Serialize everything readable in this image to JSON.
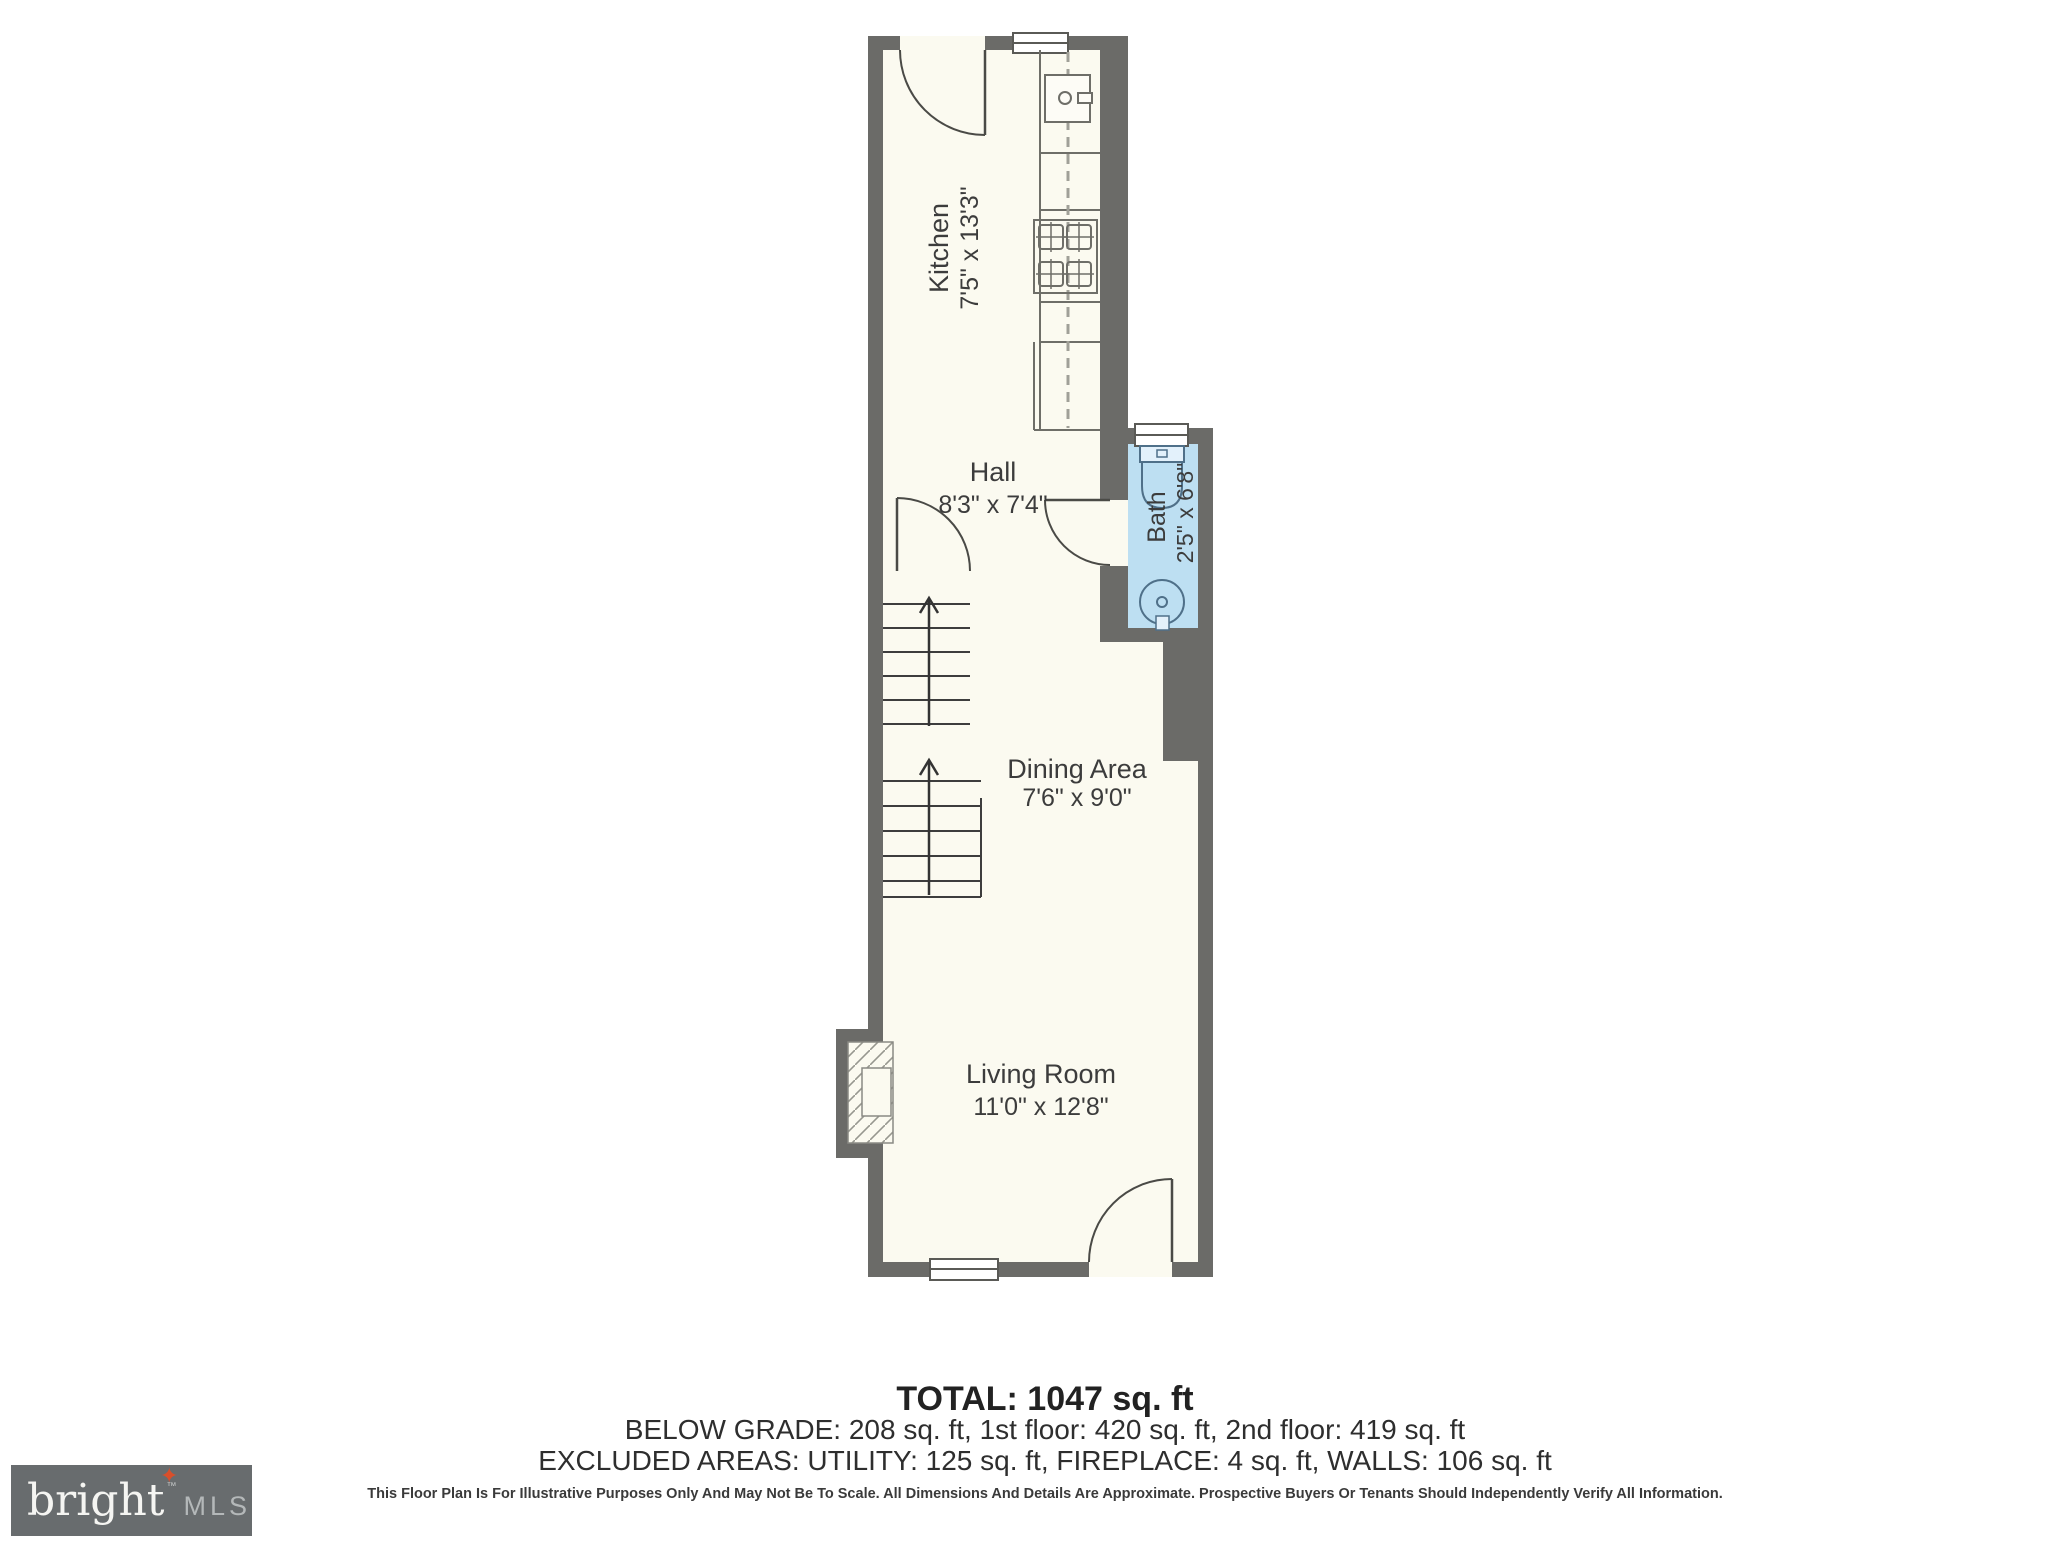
{
  "plan": {
    "rooms": [
      {
        "name": "Kitchen",
        "dims": "7'5\" x 13'3\""
      },
      {
        "name": "Hall",
        "dims": "8'3\" x 7'4\""
      },
      {
        "name": "Bath",
        "dims": "2'5\" x 6'8\""
      },
      {
        "name": "Dining Area",
        "dims": "7'6\" x 9'0\""
      },
      {
        "name": "Living Room",
        "dims": "11'0\" x 12'8\""
      }
    ],
    "colors": {
      "wall": "#6b6b68",
      "floor": "#fbfaf0",
      "bath_fill": "#bddff2",
      "label_text": "#3c3c3c",
      "logo_box": "#686c6e",
      "logo_brand": "#f5f5f2",
      "logo_star": "#d94f2b",
      "logo_mls": "#b4b8b9"
    }
  },
  "summary": {
    "total": "TOTAL: 1047 sq. ft",
    "below_grade": "BELOW GRADE: 208 sq. ft, 1st floor: 420 sq. ft, 2nd floor: 419 sq. ft",
    "excluded": "EXCLUDED AREAS: UTILITY: 125 sq. ft, FIREPLACE: 4 sq. ft, WALLS: 106 sq. ft",
    "disclaimer": "This Floor Plan Is For Illustrative Purposes Only And May Not Be To Scale. All Dimensions And Details Are Approximate. Prospective Buyers Or Tenants Should Independently Verify All Information."
  },
  "logo": {
    "brand": "bright",
    "tm": "™",
    "suffix": "MLS",
    "star": "✦"
  }
}
